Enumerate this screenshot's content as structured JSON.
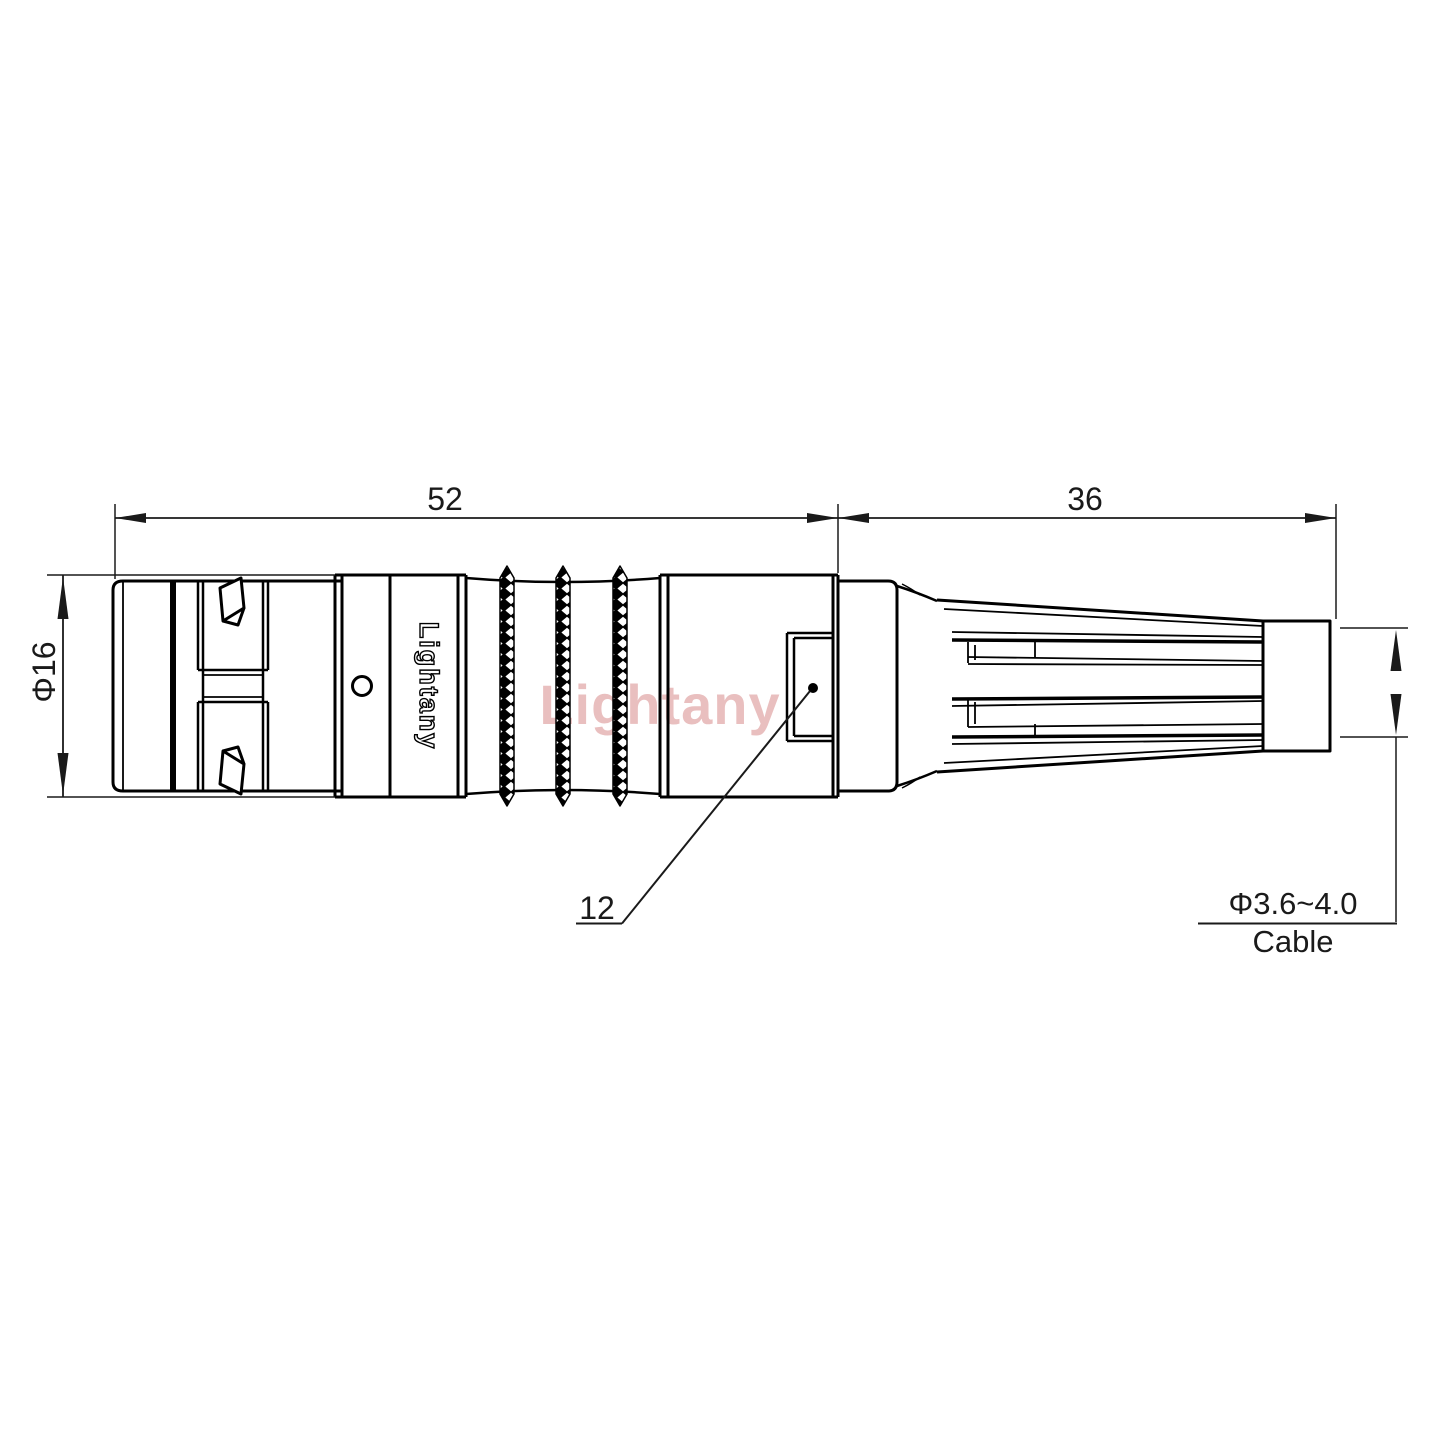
{
  "page": {
    "background": "#ffffff",
    "line_color": "#000000"
  },
  "drawing": {
    "dimensions": {
      "main_length": "52",
      "boot_length": "36",
      "body_diameter": "Φ16",
      "inner_detail": "12",
      "cable_range": "Φ3.6~4.0",
      "cable_word": "Cable"
    },
    "branding": {
      "shell_text": "Lightany",
      "watermark_text": "Lightany",
      "watermark_color": "#c85a5a"
    }
  }
}
